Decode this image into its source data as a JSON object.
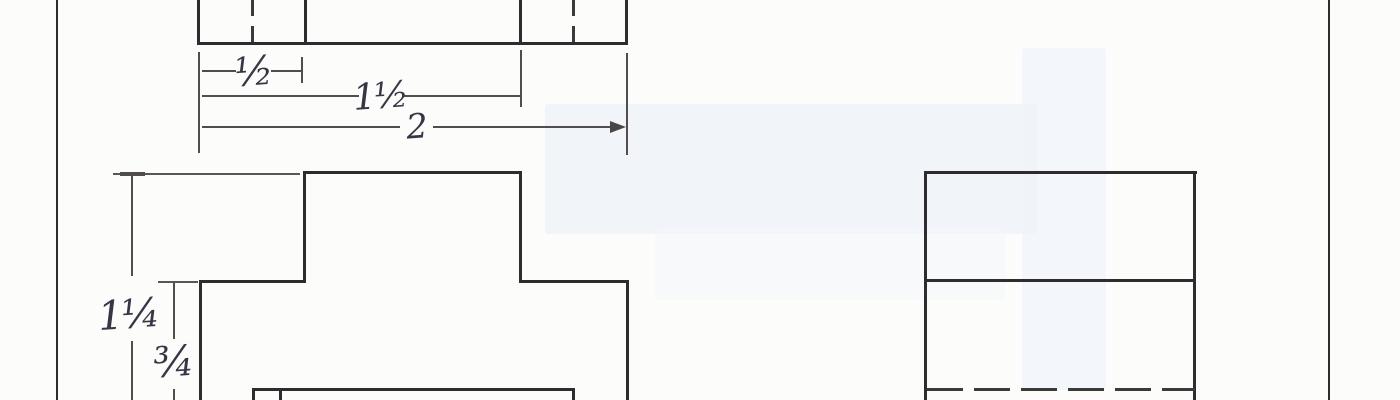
{
  "drawing": {
    "description": "Hand-drawn orthographic projection sketch (top view, front view, right side view) with dimension lines",
    "labels": {
      "half": "½",
      "one_and_half": "1½",
      "two": "2",
      "one_and_quarter": "1¼",
      "three_quarter": "¾"
    },
    "colors": {
      "outline": "#2e2c2e",
      "dimension_line": "#514d4f",
      "ink": "#3a3445",
      "paper": "#fcfcfa",
      "artifact_blue": "#edf1f8"
    }
  }
}
